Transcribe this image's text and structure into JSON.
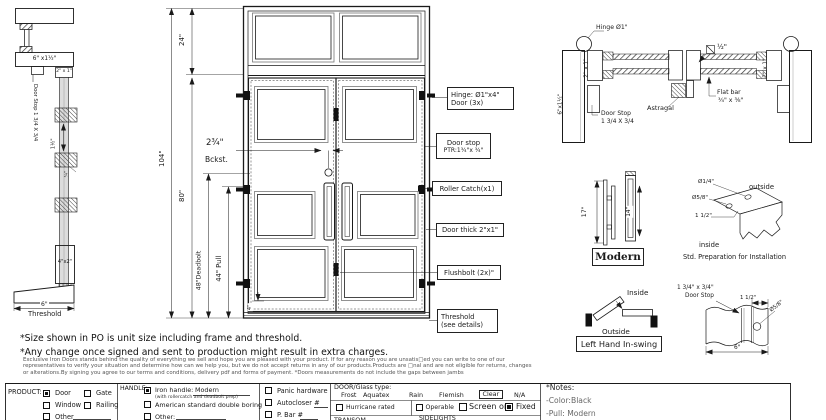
{
  "left_section": {
    "jamb_size": "6\" x1½\"",
    "door_stop_note": "Door Stop 1 3/4 X 3/4",
    "bar": "2\" x 1\"",
    "dim_gap": "1½\"",
    "dim_small": "¾\"",
    "sill_block": "4\"x2\"",
    "threshold_width": "6\"",
    "threshold_label": "Threshold"
  },
  "elevation": {
    "dims": {
      "total_height": "104\"",
      "transom_height": "24\"",
      "door_height": "80\"",
      "deadbolt": "48\"Deadbolt",
      "pull": "44\" Pull",
      "backset": "2¾\"",
      "backset_label": "Bckst.",
      "bottom_rail": "4\""
    },
    "callouts": {
      "hinge_l1": "Hinge: Ø1\"x4\"",
      "hinge_l2": "Door (3x)",
      "doorstop_l1": "Door stop",
      "doorstop_l2": "PTR:1¾\"x ¾\"",
      "roller": "Roller Catch(x1)",
      "thick": "Door thick 2\"x1\"",
      "flushbolt": "Flushbolt (2x)\"",
      "threshold_l1": "Threshold",
      "threshold_l2": "(see details)"
    }
  },
  "plan_section": {
    "hinge": "Hinge Ø1\"",
    "bar_left": "2\" x 1\"",
    "bar_right": "2\" x 1\"",
    "jamb": "6\"x1½\"",
    "doorstop_l1": "Door Stop",
    "doorstop_l2": "1 3/4 X 3/4",
    "astragal": "Astragal",
    "flatbar_l1": "Flat bar",
    "flatbar_l2": "¾\" x ⅜\"",
    "square_dim": "½\""
  },
  "handle_detail": {
    "h17": "17\"",
    "h14": "14\"",
    "label": "Modern"
  },
  "prep_detail": {
    "d14": "Ø1/4\"",
    "d58": "Ø5/8\"",
    "d112": "1 1/2\"",
    "outside": "outside",
    "inside": "inside",
    "caption": "Std. Preparation for Installation"
  },
  "swing_detail": {
    "inside": "Inside",
    "outside": "Outside",
    "label": "Left Hand In-swing"
  },
  "stop_detail": {
    "l1": "1 3/4\" x 3/4\"",
    "l2": "Door Stop",
    "d112": "1 1/2\"",
    "d58": "Ø5/8\"",
    "d6": "6\""
  },
  "notes": {
    "line1": "*Size shown in PO is unit size including frame and threshold.",
    "line2": "*Any change once signed and sent to production might result in extra charges.",
    "fine1": "Exclusive Iron Doors stands behind the quality of everything we sell and hope you are pleased with your product. If for any reason you are unsatis□ed you can write to one of our",
    "fine2": "representatives to verify your situation and determine how can we help you, but we do not accept returns in any of our products.Products are □nal and are not eligible for returns, changes",
    "fine3": "or alterations.By signing you agree to our terms and conditions, delivery pdf and forms of payment. *Doors measurements do not include the gaps between jambs"
  },
  "form": {
    "product": {
      "label": "PRODUCT:",
      "options": [
        {
          "label": "Door",
          "checked": true
        },
        {
          "label": "Gate",
          "checked": false
        },
        {
          "label": "Window",
          "checked": false
        },
        {
          "label": "Railing",
          "checked": false
        },
        {
          "label": "Other",
          "checked": false
        }
      ]
    },
    "handle": {
      "label": "HANDLE:",
      "iron": "Iron handle:",
      "iron_value": "Modern",
      "iron_checked": true,
      "iron_sub": "(with rollercatch and deadbolt prep)",
      "opt2": "American standard double boring",
      "opt2_checked": false,
      "opt3": "Other:",
      "opt3_checked": false
    },
    "hardware": {
      "panic": "Panic hardware",
      "panic_checked": false,
      "autocloser": "Autocloser #",
      "autocloser_checked": false,
      "pbar": "P. Bar #",
      "pbar_checked": false
    },
    "glass": {
      "label": "DOOR/Glass type:",
      "types": [
        "Frost",
        "Aquatex",
        "Rain",
        "Flemish",
        "Clear",
        "N/A"
      ],
      "selected": "Clear",
      "hurricane": "Hurricane rated",
      "hurricane_checked": false,
      "operable": "Operable",
      "operable_checked": false,
      "screen": "Screen or",
      "screen_checked": false,
      "fixed": "Fixed",
      "fixed_checked": true,
      "transom": "TRANSOM",
      "sidelights": "SIDELIGHTS"
    },
    "notes_box": {
      "title": "*Notes:",
      "color": "-Color:Black",
      "pull": "-Pull: Modern"
    }
  },
  "colors": {
    "line": "#1a1a1a",
    "gray_text": "#666",
    "fine_text": "#555"
  }
}
